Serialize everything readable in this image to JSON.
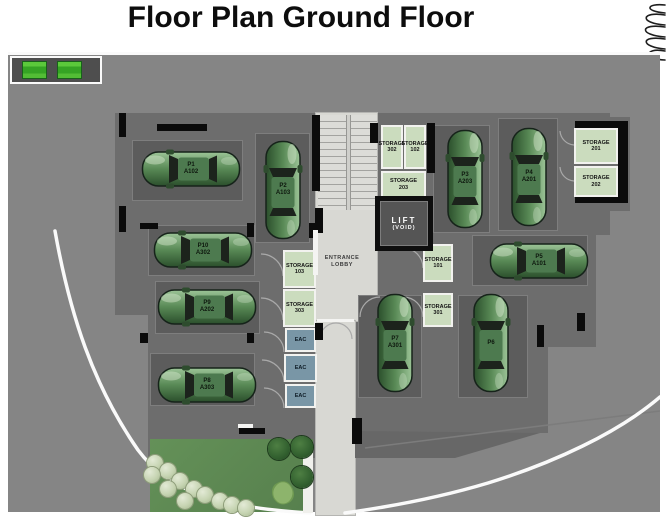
{
  "title": "Floor Plan Ground Floor",
  "plan": {
    "lift": {
      "line1": "LIFT",
      "line2": "(VOID)"
    },
    "entrance_lobby": {
      "line1": "ENTRANCE",
      "line2": "LOBBY"
    },
    "parking_spaces": [
      {
        "space": "P1",
        "unit": "A102"
      },
      {
        "space": "P2",
        "unit": "A103"
      },
      {
        "space": "P3",
        "unit": "A203"
      },
      {
        "space": "P4",
        "unit": "A201"
      },
      {
        "space": "P5",
        "unit": "A101"
      },
      {
        "space": "P6",
        "unit": ""
      },
      {
        "space": "P7",
        "unit": "A301"
      },
      {
        "space": "P8",
        "unit": "A303"
      },
      {
        "space": "P9",
        "unit": "A202"
      },
      {
        "space": "P10",
        "unit": "A302"
      }
    ],
    "storage_rooms": [
      {
        "line1": "STORAGE",
        "line2": "302"
      },
      {
        "line1": "STORAGE",
        "line2": "102"
      },
      {
        "line1": "STORAGE",
        "line2": "203"
      },
      {
        "line1": "STORAGE",
        "line2": "201"
      },
      {
        "line1": "STORAGE",
        "line2": "202"
      },
      {
        "line1": "STORAGE",
        "line2": "101"
      },
      {
        "line1": "STORAGE",
        "line2": "301"
      },
      {
        "line1": "STORAGE",
        "line2": "103"
      },
      {
        "line1": "STORAGE",
        "line2": "303"
      }
    ],
    "eac_rooms": [
      {
        "label": "EAC"
      },
      {
        "label": "EAC"
      },
      {
        "label": "EAC"
      }
    ]
  },
  "colors": {
    "car_green": "#4e7d4a",
    "storage_green": "#cbdcbe",
    "eac_blue": "#7996a6",
    "site_gray": "#858585",
    "building_gray": "#6d6d6d",
    "walkway_gray": "#d8d8d3",
    "legend_green": "#46c32e"
  }
}
